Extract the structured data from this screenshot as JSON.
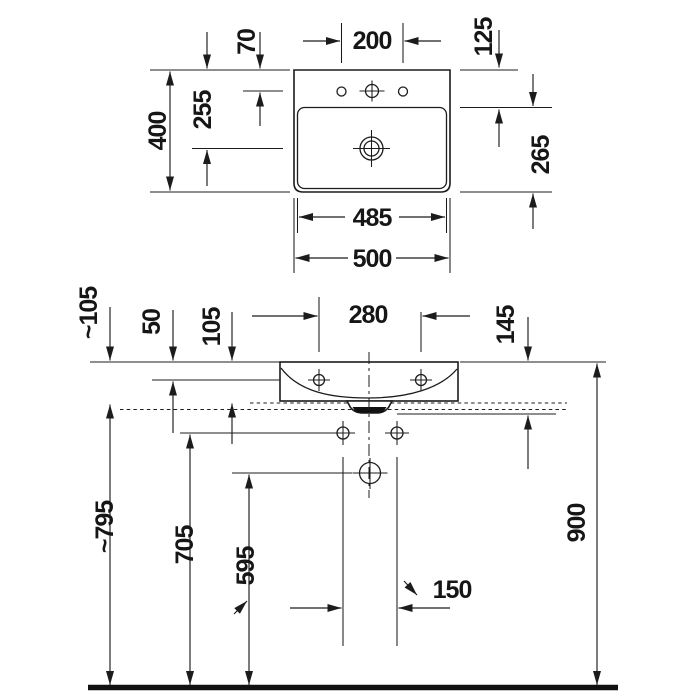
{
  "drawing": {
    "product": "wall-mounted washbasin technical drawing",
    "views": {
      "top": {
        "dimensions": {
          "faucet_hole_spacing": "200",
          "tap_hole_offset_from_rear": "70",
          "drain_offset_from_rear": "255",
          "overall_depth": "400",
          "rear_deck_depth": "125",
          "basin_inner_depth": "265",
          "inner_width": "485",
          "overall_width": "500"
        }
      },
      "front": {
        "dimensions": {
          "approx_front_apron_height": "~105",
          "rim_to_hanger_holes": "50",
          "body_height": "105",
          "mounting_hole_spacing": "280",
          "rim_to_lower_reference": "145",
          "floor_to_basin_underside": "~795",
          "floor_to_fixing_holes": "705",
          "floor_to_drain_outlet": "595",
          "floor_to_rim": "900",
          "fixing_hole_spacing": "150"
        }
      }
    }
  },
  "colors": {
    "line": "#1c1c1c",
    "background": "#ffffff"
  }
}
